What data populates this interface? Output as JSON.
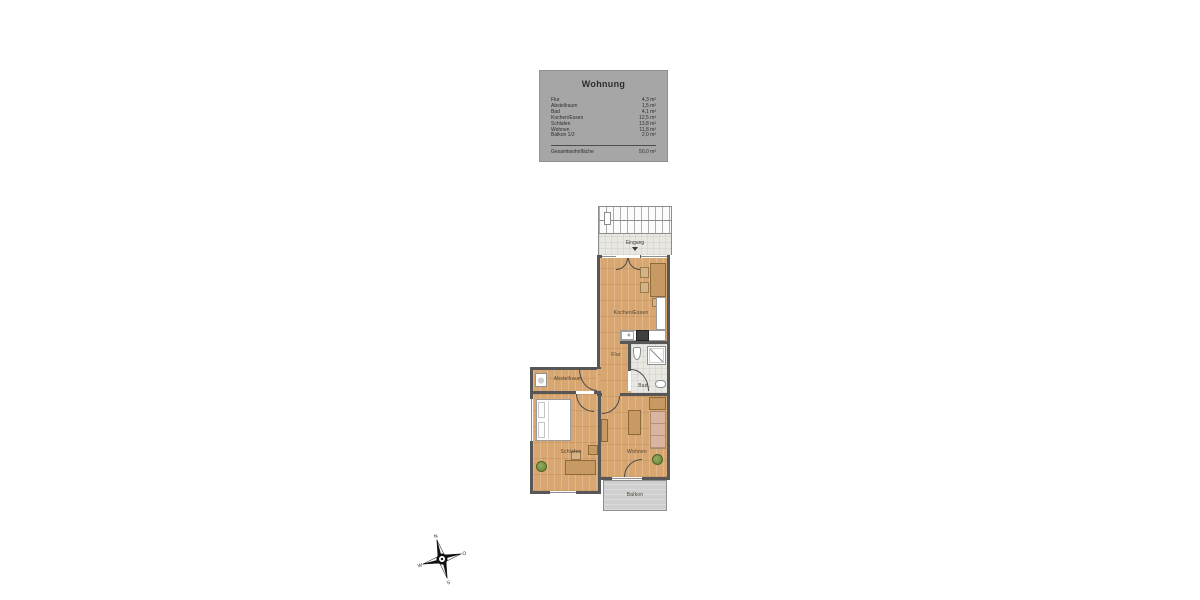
{
  "legend": {
    "title": "Wohnung",
    "rows": [
      {
        "label": "Flur",
        "value": "4,3 m²"
      },
      {
        "label": "Abstellraum",
        "value": "1,5 m²"
      },
      {
        "label": "Bad",
        "value": "4,1 m²"
      },
      {
        "label": "Kochen/Essen",
        "value": "12,5 m²"
      },
      {
        "label": "Schlafen",
        "value": "13,8 m²"
      },
      {
        "label": "Wohnen",
        "value": "11,8 m²"
      },
      {
        "label": "Balkon 1/2",
        "value": "2,0 m²"
      }
    ],
    "total_label": "Gesamtwohnfläche",
    "total_value": "50,0 m²"
  },
  "plan": {
    "entrance_label": "Eingang",
    "rooms": {
      "kitchen": "Kochen/Essen",
      "hall": "Flur",
      "bath": "Bad",
      "storage": "Abstellraum",
      "bedroom": "Schlafen",
      "living": "Wohnen",
      "balcony": "Balkon"
    }
  },
  "compass": {
    "north": "N",
    "east": "O",
    "south": "S",
    "west": "W"
  },
  "colors": {
    "wall": "#575757",
    "wood_floor": "#d8a771",
    "tile_floor": "#e9e7e2",
    "legend_bg": "#a6a6a6",
    "balcony_bg": "#cfcfcf",
    "furniture_tan": "#c89a63",
    "sofa": "#d9b49e",
    "plant_green": "#7d9b4e"
  }
}
